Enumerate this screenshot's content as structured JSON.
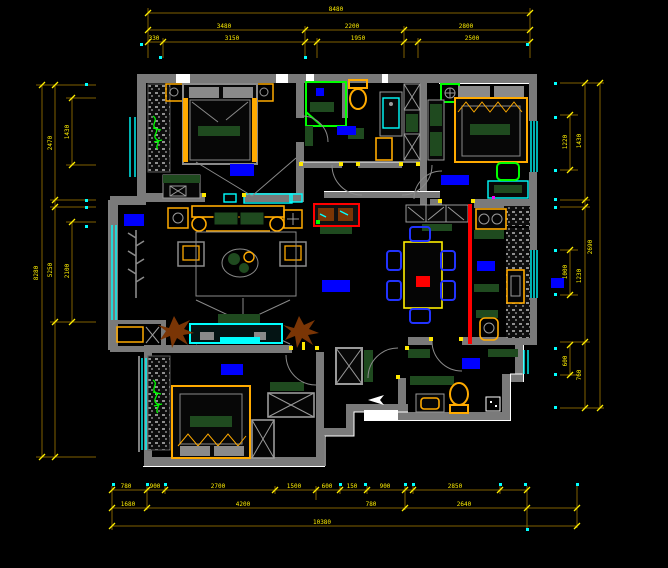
{
  "canvas": {
    "title": "apartment-floor-plan",
    "width": 668,
    "height": 568,
    "background": "#000000",
    "description": "CAD apartment furniture floor plan with dimension chains"
  },
  "colors": {
    "wall": "#7a7a7a",
    "wall_light": "#9a9a9a",
    "dim_line": "#7f6000",
    "dim_text": "#ffee00",
    "window": "#00ffff",
    "furniture": "#ffaa00",
    "upholstery": "#1f4a1f",
    "label_block": "#0000ff",
    "accent_red": "#ff0000",
    "fixture_green": "#00ff00",
    "plant_brown": "#7a3505",
    "chair_blue": "#2233ff",
    "trim_white": "#ffffff"
  },
  "dim_labels": {
    "top_row1": [
      "8480"
    ],
    "top_row2": [
      "3480",
      "2200",
      "2800"
    ],
    "top_row3": [
      "330",
      "3150",
      "1950",
      "2500"
    ],
    "bottom_row1": [
      "780",
      "900",
      "2700",
      "1500",
      "600",
      "150",
      "900",
      "2850"
    ],
    "bottom_row2": [
      "1680",
      "4200",
      "780",
      "2640"
    ],
    "bottom_row3": [
      "10380"
    ],
    "left_col": [
      "1430",
      "2470",
      "8280",
      "5250",
      "2100"
    ],
    "right_col": [
      "1220",
      "1430",
      "1000",
      "1230",
      "600",
      "760",
      "2690"
    ]
  }
}
